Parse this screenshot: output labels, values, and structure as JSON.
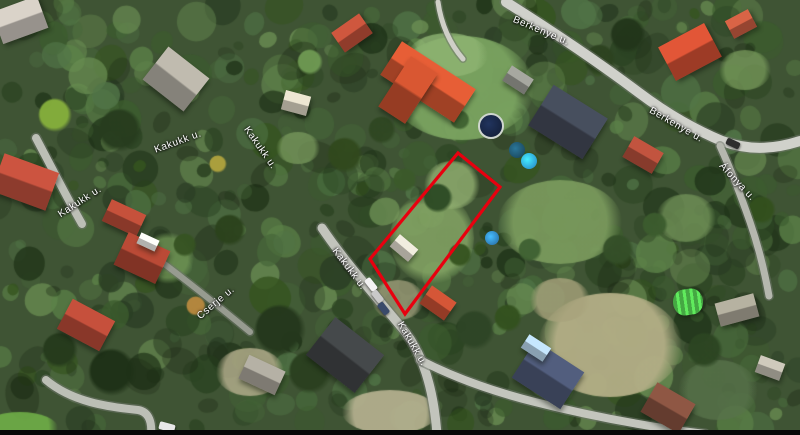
{
  "map": {
    "type": "satellite-aerial-view",
    "parcel_outline": {
      "color": "#e8000f",
      "stroke_width": 3.2,
      "points": [
        [
          458,
          153
        ],
        [
          500,
          187
        ],
        [
          405,
          314
        ],
        [
          370,
          259
        ]
      ]
    },
    "street_labels": [
      {
        "text": "Kakukk u.",
        "x": 178,
        "y": 142,
        "rot": -20
      },
      {
        "text": "Kakukk u.",
        "x": 260,
        "y": 148,
        "rot": 55
      },
      {
        "text": "Kakukk u.",
        "x": 80,
        "y": 202,
        "rot": -33
      },
      {
        "text": "Kakukk u.",
        "x": 349,
        "y": 269,
        "rot": 53
      },
      {
        "text": "Kakukk u.",
        "x": 412,
        "y": 344,
        "rot": 60
      },
      {
        "text": "Cserje u.",
        "x": 216,
        "y": 303,
        "rot": -40
      },
      {
        "text": "Berkenye u.",
        "x": 541,
        "y": 31,
        "rot": 23
      },
      {
        "text": "Berkenye u.",
        "x": 676,
        "y": 125,
        "rot": 30
      },
      {
        "text": "Áfonya u.",
        "x": 737,
        "y": 182,
        "rot": 47
      }
    ],
    "roads": [
      {
        "name": "kakukk-main",
        "d": "M 322,228 C 345,262 372,292 402,328 C 424,354 434,392 437,435",
        "width": 9,
        "color": "#c2c4bc"
      },
      {
        "name": "kakukk-left-a",
        "d": "M 36,138 C 52,168 66,196 82,224",
        "width": 8,
        "color": "#bcbfb6"
      },
      {
        "name": "kakukk-left-b",
        "d": "M 46,380 C 72,402 108,407 138,410 C 150,412 152,424 151,435",
        "width": 8,
        "color": "#bcbfb6"
      },
      {
        "name": "cserje",
        "d": "M 146,250 C 186,280 216,304 250,332",
        "width": 6,
        "color": "#979b90"
      },
      {
        "name": "berkenye",
        "d": "M 506,2 C 544,26 590,56 638,92 C 670,116 696,130 722,141 C 752,152 778,148 800,141",
        "width": 10,
        "color": "#d0d1cb"
      },
      {
        "name": "afonya",
        "d": "M 720,146 C 731,170 741,196 750,222 C 758,245 764,268 769,296",
        "width": 7,
        "color": "#b5b7ae"
      },
      {
        "name": "south-branch",
        "d": "M 420,360 C 455,378 495,392 535,402 C 590,416 650,427 705,434",
        "width": 8,
        "color": "#c3c5bd"
      },
      {
        "name": "driveway",
        "d": "M 438,2 C 441,24 450,44 463,59",
        "width": 5,
        "color": "#cfcfc7"
      }
    ],
    "houses": [
      {
        "x": 20,
        "y": 20,
        "w": 48,
        "h": 34,
        "rot": -20,
        "color": "#b9b3ab"
      },
      {
        "x": 176,
        "y": 79,
        "w": 52,
        "h": 42,
        "rot": 38,
        "color": "#a39f95"
      },
      {
        "x": 352,
        "y": 33,
        "w": 34,
        "h": 24,
        "rot": -35,
        "color": "#b04a35"
      },
      {
        "x": 428,
        "y": 82,
        "w": 88,
        "h": 40,
        "rot": 33,
        "color": "#c4502e"
      },
      {
        "x": 408,
        "y": 90,
        "w": 32,
        "h": 60,
        "rot": 33,
        "color": "#b84a2b"
      },
      {
        "x": 518,
        "y": 80,
        "w": 26,
        "h": 18,
        "rot": 33,
        "color": "#8e8f88"
      },
      {
        "x": 568,
        "y": 122,
        "w": 64,
        "h": 48,
        "rot": 32,
        "color": "#3d4350"
      },
      {
        "x": 690,
        "y": 52,
        "w": 52,
        "h": 38,
        "rot": -28,
        "color": "#c0492f"
      },
      {
        "x": 741,
        "y": 24,
        "w": 26,
        "h": 20,
        "rot": -28,
        "color": "#b8553c"
      },
      {
        "x": 643,
        "y": 155,
        "w": 34,
        "h": 24,
        "rot": 30,
        "color": "#a54836"
      },
      {
        "x": 296,
        "y": 103,
        "w": 26,
        "h": 20,
        "rot": 15,
        "color": "#c9c3b2"
      },
      {
        "x": 124,
        "y": 218,
        "w": 38,
        "h": 24,
        "rot": 25,
        "color": "#a84532"
      },
      {
        "x": 142,
        "y": 258,
        "w": 46,
        "h": 36,
        "rot": 25,
        "color": "#9e3f2e"
      },
      {
        "x": 148,
        "y": 242,
        "w": 20,
        "h": 12,
        "rot": 25,
        "color": "#d8d8d4"
      },
      {
        "x": 25,
        "y": 182,
        "w": 58,
        "h": 40,
        "rot": 20,
        "color": "#ad4837"
      },
      {
        "x": 86,
        "y": 325,
        "w": 48,
        "h": 34,
        "rot": 28,
        "color": "#a84433"
      },
      {
        "x": 262,
        "y": 375,
        "w": 40,
        "h": 26,
        "rot": 25,
        "color": "#9a968c"
      },
      {
        "x": 345,
        "y": 355,
        "w": 62,
        "h": 48,
        "rot": 38,
        "color": "#3b3e40"
      },
      {
        "x": 404,
        "y": 248,
        "w": 24,
        "h": 16,
        "rot": 40,
        "color": "#cdc9bd"
      },
      {
        "x": 438,
        "y": 303,
        "w": 30,
        "h": 22,
        "rot": 35,
        "color": "#b5492f"
      },
      {
        "x": 548,
        "y": 375,
        "w": 58,
        "h": 44,
        "rot": 33,
        "color": "#46506b"
      },
      {
        "x": 536,
        "y": 348,
        "w": 26,
        "h": 16,
        "rot": 33,
        "color": "#a8c4d8"
      },
      {
        "x": 668,
        "y": 408,
        "w": 44,
        "h": 34,
        "rot": 30,
        "color": "#7a4a3a"
      },
      {
        "x": 737,
        "y": 310,
        "w": 40,
        "h": 24,
        "rot": -15,
        "color": "#9b9789"
      },
      {
        "x": 770,
        "y": 368,
        "w": 26,
        "h": 18,
        "rot": 20,
        "color": "#b0aca0"
      },
      {
        "x": 688,
        "y": 302,
        "w": 30,
        "h": 26,
        "rot": -8,
        "color": "#45a843",
        "type": "greenhouse"
      }
    ],
    "pools": [
      {
        "x": 489,
        "y": 124,
        "r": 11,
        "color": "#16233f",
        "ring": "#cfd6cf"
      },
      {
        "x": 517,
        "y": 150,
        "r": 8,
        "color": "#1d4f66"
      },
      {
        "x": 529,
        "y": 161,
        "r": 8,
        "color": "#2e9fd4"
      },
      {
        "x": 492,
        "y": 238,
        "r": 7,
        "color": "#2f7fb8"
      }
    ],
    "cars": [
      {
        "x": 371,
        "y": 284,
        "w": 14,
        "h": 7,
        "rot": 52,
        "color": "#f2f2f2"
      },
      {
        "x": 377,
        "y": 296,
        "w": 13,
        "h": 7,
        "rot": 52,
        "color": "#c9c9c9"
      },
      {
        "x": 383,
        "y": 308,
        "w": 13,
        "h": 7,
        "rot": 52,
        "color": "#3a4a6a"
      },
      {
        "x": 167,
        "y": 427,
        "w": 16,
        "h": 8,
        "rot": 15,
        "color": "#e8e8e8"
      },
      {
        "x": 733,
        "y": 143,
        "w": 14,
        "h": 7,
        "rot": 25,
        "color": "#2e2e2e"
      }
    ],
    "ground_patches": [
      {
        "x": 462,
        "y": 88,
        "rx": 72,
        "ry": 52,
        "color": "#7aa360",
        "alpha": 0.95
      },
      {
        "x": 448,
        "y": 55,
        "rx": 40,
        "ry": 22,
        "color": "#8fb573",
        "alpha": 0.8
      },
      {
        "x": 560,
        "y": 222,
        "rx": 62,
        "ry": 42,
        "color": "#7c9c5e",
        "alpha": 0.9
      },
      {
        "x": 610,
        "y": 345,
        "rx": 72,
        "ry": 52,
        "color": "#b3ae86",
        "alpha": 0.95
      },
      {
        "x": 560,
        "y": 300,
        "rx": 30,
        "ry": 22,
        "color": "#a8a37c",
        "alpha": 0.8
      },
      {
        "x": 390,
        "y": 412,
        "rx": 48,
        "ry": 22,
        "color": "#b8b392",
        "alpha": 0.9
      },
      {
        "x": 432,
        "y": 238,
        "rx": 42,
        "ry": 46,
        "color": "#85a565",
        "alpha": 0.85
      },
      {
        "x": 452,
        "y": 185,
        "rx": 28,
        "ry": 24,
        "color": "#93b172",
        "alpha": 0.8
      },
      {
        "x": 398,
        "y": 300,
        "rx": 26,
        "ry": 20,
        "color": "#a9a682",
        "alpha": 0.7
      },
      {
        "x": 250,
        "y": 372,
        "rx": 34,
        "ry": 24,
        "color": "#b0ab8a",
        "alpha": 0.85
      },
      {
        "x": 168,
        "y": 258,
        "rx": 26,
        "ry": 26,
        "color": "#6f9454",
        "alpha": 0.8
      },
      {
        "x": 20,
        "y": 428,
        "rx": 38,
        "ry": 16,
        "color": "#6fae47",
        "alpha": 0.9
      },
      {
        "x": 686,
        "y": 218,
        "rx": 30,
        "ry": 24,
        "color": "#74955a",
        "alpha": 0.75
      },
      {
        "x": 745,
        "y": 70,
        "rx": 26,
        "ry": 20,
        "color": "#7da05f",
        "alpha": 0.7
      },
      {
        "x": 298,
        "y": 148,
        "rx": 22,
        "ry": 16,
        "color": "#7d9f60",
        "alpha": 0.7
      },
      {
        "x": 718,
        "y": 390,
        "rx": 40,
        "ry": 30,
        "color": "#57724a",
        "alpha": 0.8
      }
    ],
    "accent_trees": [
      {
        "x": 438,
        "y": 198,
        "r": 15,
        "color": "#2c4a24"
      },
      {
        "x": 55,
        "y": 115,
        "r": 17,
        "color": "#86b03c"
      },
      {
        "x": 218,
        "y": 164,
        "r": 9,
        "color": "#b0a33e"
      },
      {
        "x": 196,
        "y": 306,
        "r": 10,
        "color": "#b9893f"
      },
      {
        "x": 310,
        "y": 62,
        "r": 13,
        "color": "#6f9a53"
      },
      {
        "x": 280,
        "y": 330,
        "r": 26,
        "color": "#24371c"
      },
      {
        "x": 310,
        "y": 372,
        "r": 22,
        "color": "#2a3f1f"
      },
      {
        "x": 475,
        "y": 330,
        "r": 20,
        "color": "#2e4526"
      },
      {
        "x": 508,
        "y": 318,
        "r": 14,
        "color": "#33511e"
      },
      {
        "x": 120,
        "y": 130,
        "r": 22,
        "color": "#273c1e"
      },
      {
        "x": 600,
        "y": 60,
        "r": 16,
        "color": "#2c421f"
      },
      {
        "x": 628,
        "y": 35,
        "r": 18,
        "color": "#22351a"
      },
      {
        "x": 345,
        "y": 155,
        "r": 18,
        "color": "#31491d"
      },
      {
        "x": 405,
        "y": 180,
        "r": 12,
        "color": "#3b5a2a"
      },
      {
        "x": 460,
        "y": 255,
        "r": 12,
        "color": "#35531f"
      },
      {
        "x": 530,
        "y": 250,
        "r": 12,
        "color": "#3f6132"
      },
      {
        "x": 618,
        "y": 250,
        "r": 16,
        "color": "#344f28"
      },
      {
        "x": 655,
        "y": 225,
        "r": 13,
        "color": "#3c5c2e"
      },
      {
        "x": 112,
        "y": 372,
        "r": 24,
        "color": "#1e3117"
      },
      {
        "x": 60,
        "y": 350,
        "r": 18,
        "color": "#253a1c"
      },
      {
        "x": 705,
        "y": 350,
        "r": 18,
        "color": "#2c4522"
      },
      {
        "x": 762,
        "y": 210,
        "r": 14,
        "color": "#33501d"
      },
      {
        "x": 460,
        "y": 120,
        "r": 10,
        "color": "#3f6131"
      },
      {
        "x": 382,
        "y": 130,
        "r": 14,
        "color": "#2f4722"
      },
      {
        "x": 230,
        "y": 230,
        "r": 16,
        "color": "#2b421c"
      },
      {
        "x": 185,
        "y": 245,
        "r": 12,
        "color": "#365322"
      }
    ],
    "palette": {
      "base_green": "#3f5434",
      "tree_greens": [
        "#1f3318",
        "#2b4422",
        "#35541f",
        "#3c5c2e",
        "#47683a",
        "#517547",
        "#5b8148",
        "#2a3d24",
        "#698c52"
      ],
      "shadow": "#15200f",
      "road_casing": "rgba(110,116,105,0.55)"
    }
  }
}
